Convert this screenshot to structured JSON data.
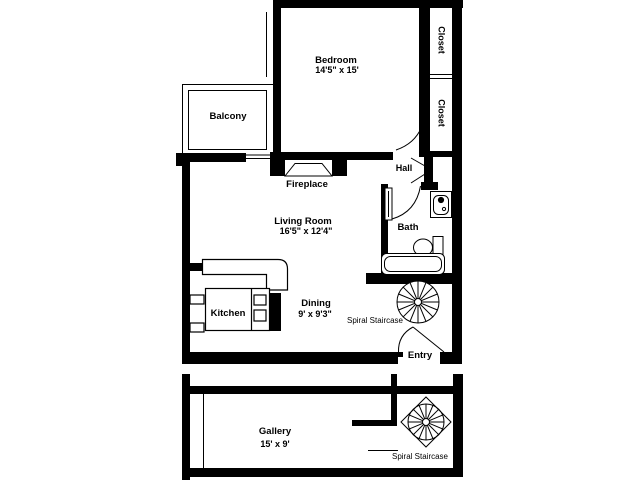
{
  "palette": {
    "background": "#ffffff",
    "ink": "#000000"
  },
  "floorplan": {
    "rooms": {
      "bedroom": {
        "label": "Bedroom",
        "dimensions": "14'5\" x 15'"
      },
      "closet_top": {
        "label": "Closet"
      },
      "closet_bottom": {
        "label": "Closet"
      },
      "balcony": {
        "label": "Balcony"
      },
      "fireplace": {
        "label": "Fireplace"
      },
      "hall": {
        "label": "Hall"
      },
      "bath": {
        "label": "Bath"
      },
      "living_room": {
        "label": "Living Room",
        "dimensions": "16'5\" x 12'4\""
      },
      "kitchen": {
        "label": "Kitchen"
      },
      "dining": {
        "label": "Dining",
        "dimensions": "9' x 9'3\""
      },
      "staircase_main": {
        "label": "Spiral Staircase"
      },
      "entry": {
        "label": "Entry"
      },
      "gallery": {
        "label": "Gallery",
        "dimensions": "15' x 9'"
      },
      "staircase_gallery": {
        "label": "Spiral Staircase"
      }
    }
  }
}
